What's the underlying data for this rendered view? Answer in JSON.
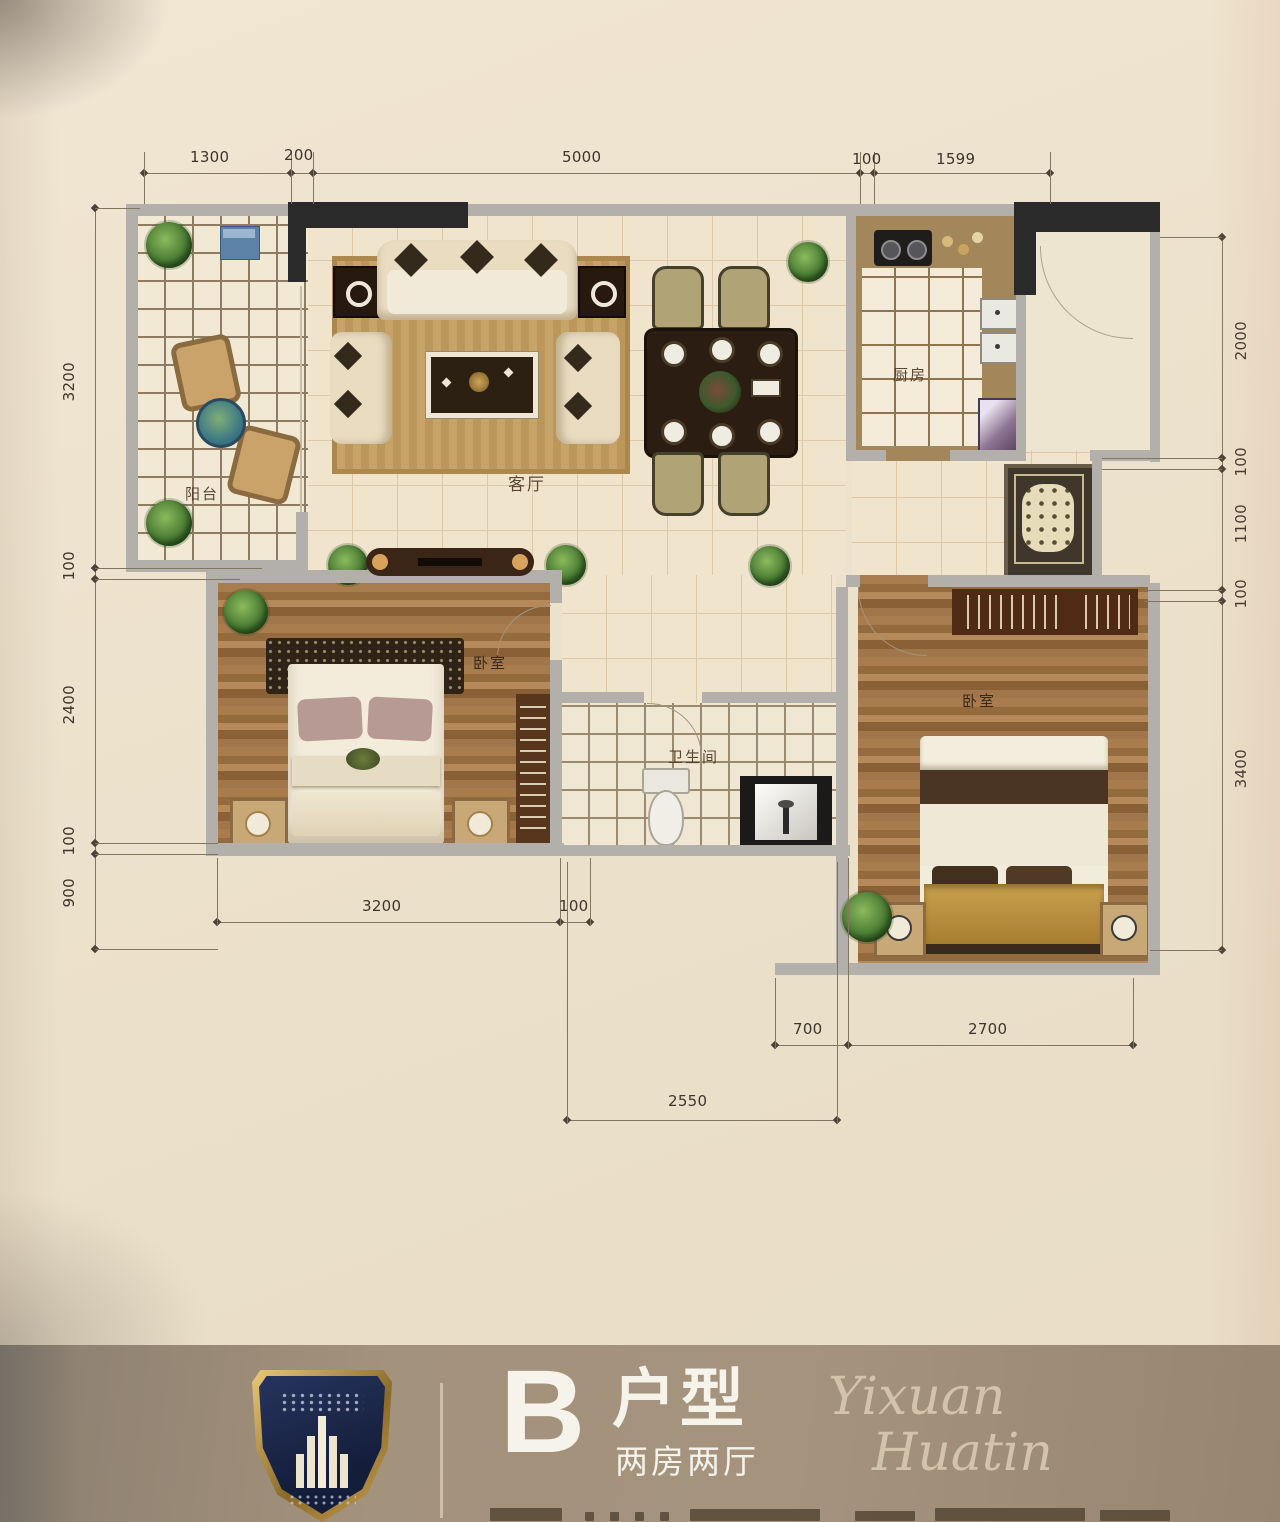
{
  "plan": {
    "rooms": {
      "balcony": "阳台",
      "living": "客厅",
      "kitchen": "厨房",
      "bedroom_left": "卧室",
      "bathroom": "卫生间",
      "bedroom_right": "卧室"
    },
    "dims": {
      "top": [
        "1300",
        "200",
        "5000",
        "100",
        "1599"
      ],
      "left": [
        "3200",
        "100",
        "2400",
        "100",
        "900"
      ],
      "right": [
        "2000",
        "100",
        "1100",
        "100",
        "3400"
      ],
      "bottom_inner": [
        "3200",
        "100"
      ],
      "bottom_mid": [
        "700",
        "2700"
      ],
      "bottom_outer": [
        "2550"
      ]
    }
  },
  "footer": {
    "unit_letter": "B",
    "unit_word": "户型",
    "unit_subtitle": "两房两厅",
    "script_line1": "Yixuan",
    "script_line2": "Huatin"
  },
  "colors": {
    "paper": "#ebe0cb",
    "band": "#9c8b76",
    "shield_navy": "#1d2a4d",
    "shield_gold": "#c9a24e",
    "wall_grey": "#b3b0ab",
    "wall_black": "#2b2a2b",
    "wood": "#9d7244",
    "text_white": "#f6f3ea"
  }
}
